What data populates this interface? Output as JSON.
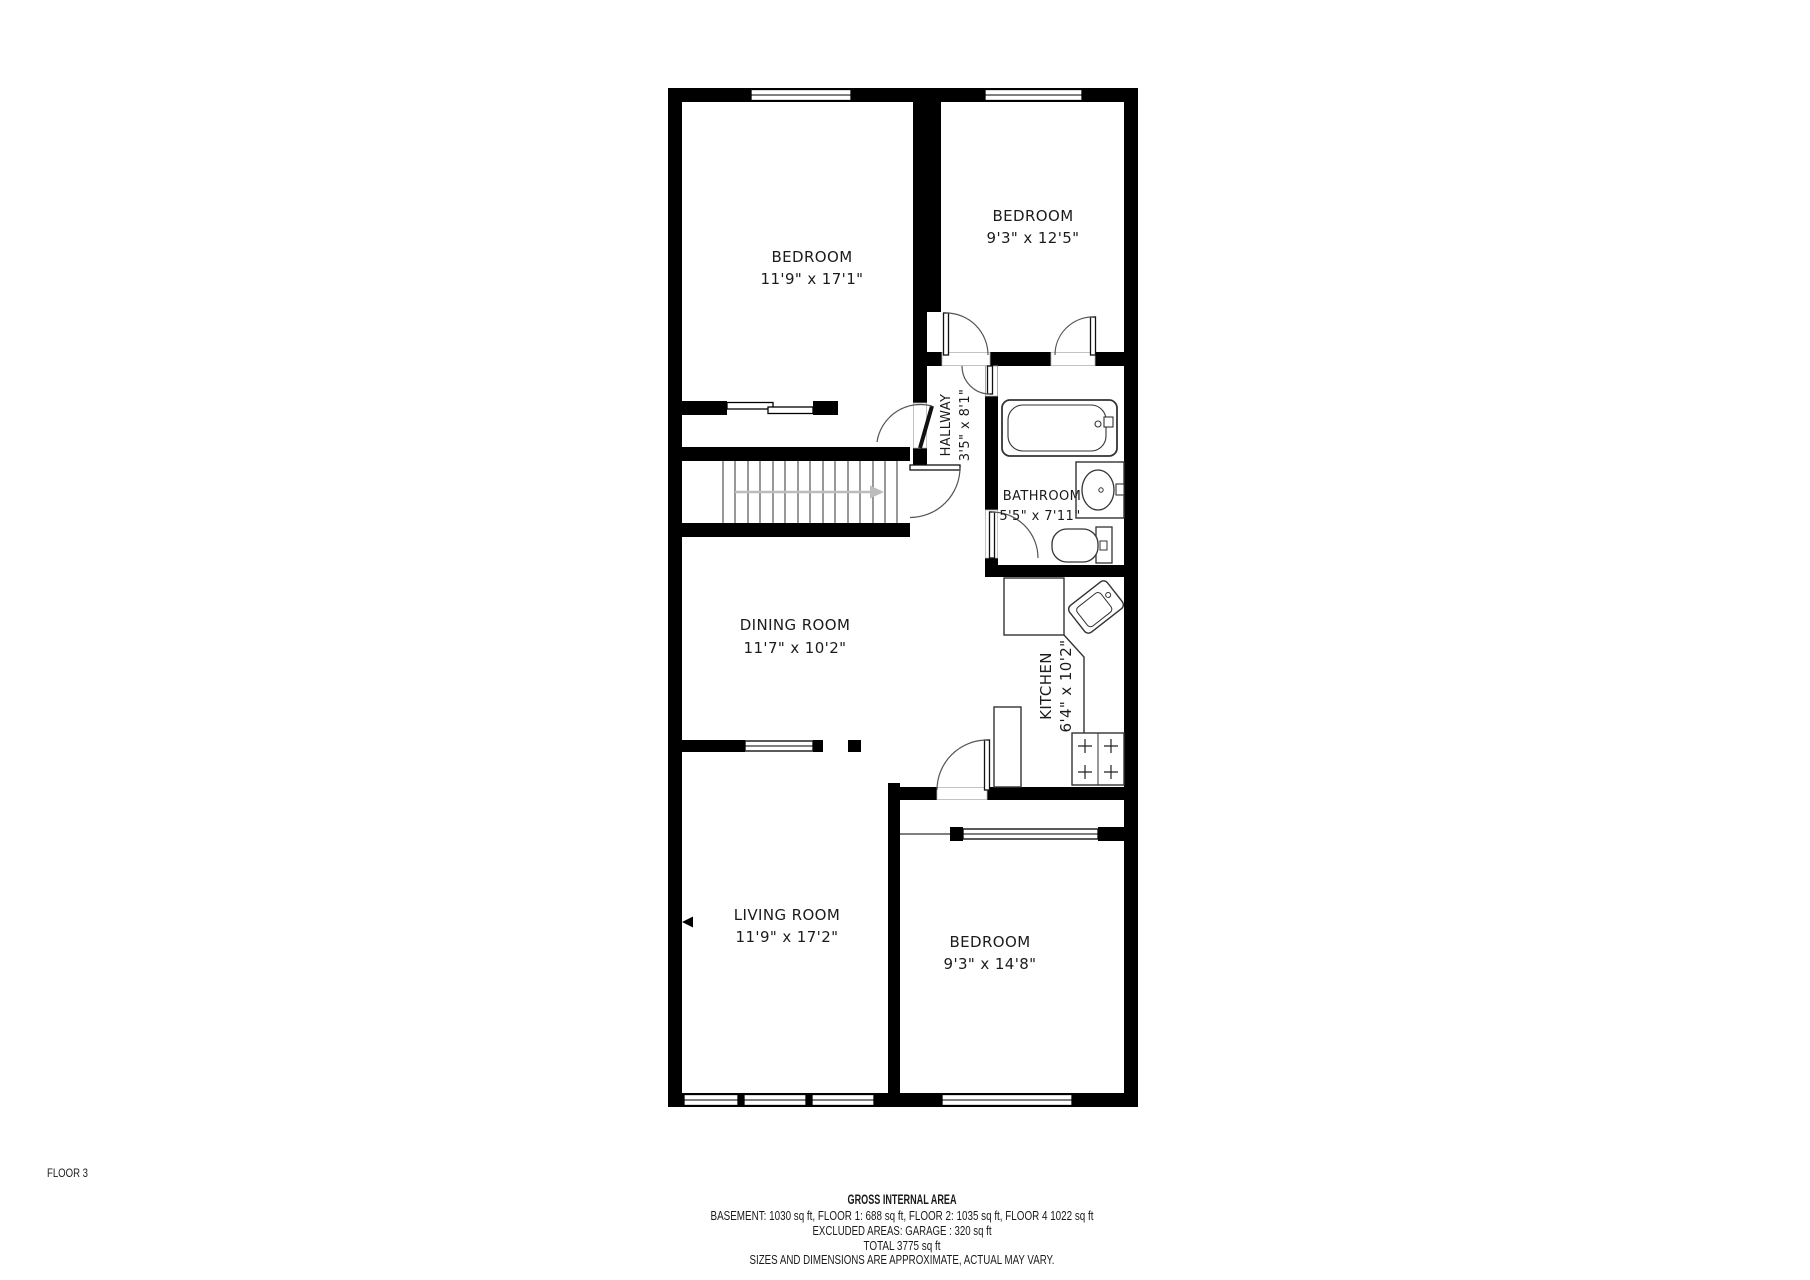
{
  "floor_label": "FLOOR 3",
  "rooms": [
    {
      "id": "bedroom-top-left",
      "name": "BEDROOM",
      "dims": "11'9\" x 17'1\""
    },
    {
      "id": "bedroom-top-right",
      "name": "BEDROOM",
      "dims": "9'3\" x 12'5\""
    },
    {
      "id": "hallway",
      "name": "HALLWAY",
      "dims": "3'5\" x 8'1\""
    },
    {
      "id": "bathroom",
      "name": "BATHROOM",
      "dims": "5'5\" x 7'11\""
    },
    {
      "id": "dining-room",
      "name": "DINING ROOM",
      "dims": "11'7\" x 10'2\""
    },
    {
      "id": "kitchen",
      "name": "KITCHEN",
      "dims": "6'4\" x 10'2\""
    },
    {
      "id": "living-room",
      "name": "LIVING ROOM",
      "dims": "11'9\" x 17'2\""
    },
    {
      "id": "bedroom-bottom",
      "name": "BEDROOM",
      "dims": "9'3\" x 14'8\""
    }
  ],
  "footer": {
    "title": "GROSS INTERNAL AREA",
    "areas_line": "BASEMENT: 1030 sq ft, FLOOR 1: 688 sq ft, FLOOR 2: 1035 sq ft,  FLOOR 4 1022 sq ft",
    "excluded_line": "EXCLUDED AREAS: GARAGE : 320 sq ft",
    "total_line": "TOTAL 3775 sq ft",
    "disclaimer": "SIZES AND DIMENSIONS ARE APPROXIMATE, ACTUAL MAY VARY."
  },
  "colors": {
    "wall": "#000000",
    "label": "#1b1b1b",
    "floor_label": "#666666",
    "disclaimer": "#9a9a9a",
    "stair_arrow": "#bdbdbd"
  }
}
